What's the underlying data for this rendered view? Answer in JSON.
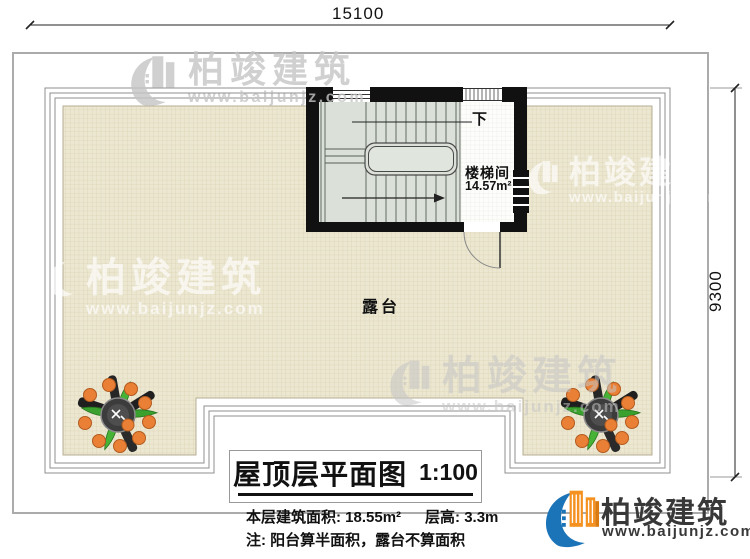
{
  "plan": {
    "dim_top": "15100",
    "dim_right": "9300",
    "down_label": "下",
    "stairwell_label": "楼梯间",
    "stairwell_area": "14.57m²",
    "terrace_label": "露台"
  },
  "title_block": {
    "title": "屋顶层平面图",
    "scale": "1:100",
    "area_text": "本层建筑面积: 18.55m²",
    "floor_height_text": "层高: 3.3m",
    "note_text": "注: 阳台算半面积，露台不算面积"
  },
  "brand": {
    "name": "柏竣建筑",
    "url": "www.baijunjz.com"
  },
  "colors": {
    "terrace_fill": "#ece7d1",
    "terrace_grid": "#dcd4b6",
    "stair_fill": "#dbe1d9",
    "wall": "#111111",
    "boundary_gray": "#9a9a9a",
    "brand_blue": "#1b74b8",
    "brand_orange": "#f59120",
    "plant_orange": "#e98036",
    "plant_green": "#3aa02e"
  }
}
